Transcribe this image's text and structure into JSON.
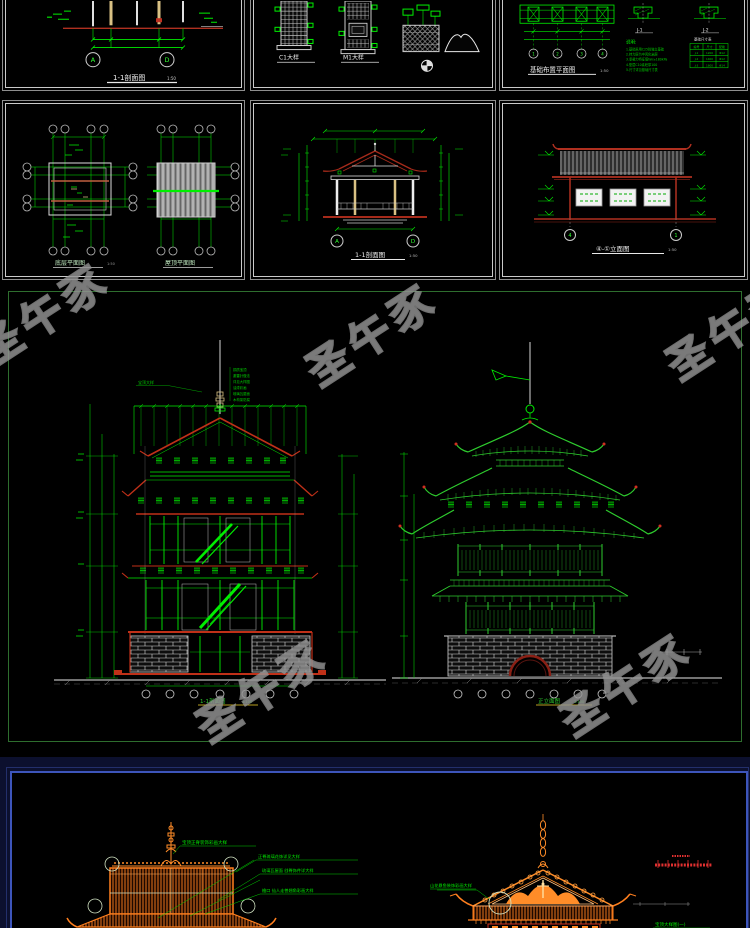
{
  "watermark": {
    "text": "圣午豕"
  },
  "colors": {
    "cad_green": "#00ee00",
    "cad_dark_red": "#b03020",
    "roof_orange": "#ff7f1e",
    "frame_blue": "#3d55bb",
    "panel_border_gray": "#c9c9c9"
  },
  "row1": {
    "panel_section": {
      "title": "1-1剖面图",
      "scale": "1:50",
      "bubbles": [
        "A",
        "D"
      ]
    },
    "panel_details": {
      "labels": [
        "C1大样",
        "M1大样"
      ]
    },
    "panel_foundation": {
      "title": "基础布置平面图",
      "scale": "1:50",
      "axis": [
        "1",
        "2",
        "3",
        "4"
      ],
      "detail_labels": [
        "J-1",
        "J-2"
      ],
      "notes_title": "说明:",
      "notes": [
        "1.基础采用C25砼独立基础",
        "2.持力层为中风化岩层",
        "3.承载力特征值fak≥180kPa",
        "4.垫层C10素砼厚100",
        "5.尺寸详见基础尺寸表"
      ],
      "table_title": "基础尺寸表",
      "table_headers": [
        "编号",
        "尺寸",
        "配筋"
      ],
      "table_rows": [
        [
          "J-1",
          "1200",
          "Φ12"
        ],
        [
          "J-2",
          "1400",
          "Φ12"
        ],
        [
          "J-3",
          "1600",
          "Φ14"
        ]
      ]
    }
  },
  "row2": {
    "panel_plans": {
      "titles": [
        "底层平面图",
        "屋顶平面图"
      ],
      "scale": "1:50"
    },
    "panel_pavilion": {
      "title": "1-1剖面图",
      "scale": "1:50",
      "bubbles": [
        "A",
        "D"
      ]
    },
    "panel_elevation": {
      "title": "④-①立面图",
      "scale": "1:50",
      "bubbles": [
        "4",
        "1"
      ]
    }
  },
  "middle": {
    "pagoda_section": {
      "title": "1-1剖面图",
      "scale": "1:100",
      "spire_note": "宝顶大样",
      "spec_lines": [
        "铜质宝顶",
        "避雷针做法",
        "详见大样图",
        "油漆彩画",
        "琉璃瓦屋面",
        "木构架防腐"
      ]
    },
    "pagoda_elevation": {
      "title": "正立面图",
      "scale": "1:100"
    }
  },
  "bottom": {
    "left": {
      "top_note": "宝顶正脊装饰彩画大样",
      "notes": [
        "正脊琉璃花饰详见大样",
        "琉璃瓦屋面 戗脊饰件详大样",
        "檐口 仙人走兽翘角彩画大样"
      ]
    },
    "right": {
      "left_note": "山花悬鱼装饰彩画大样",
      "bottom_note": "宝顶大样图(一)"
    }
  }
}
